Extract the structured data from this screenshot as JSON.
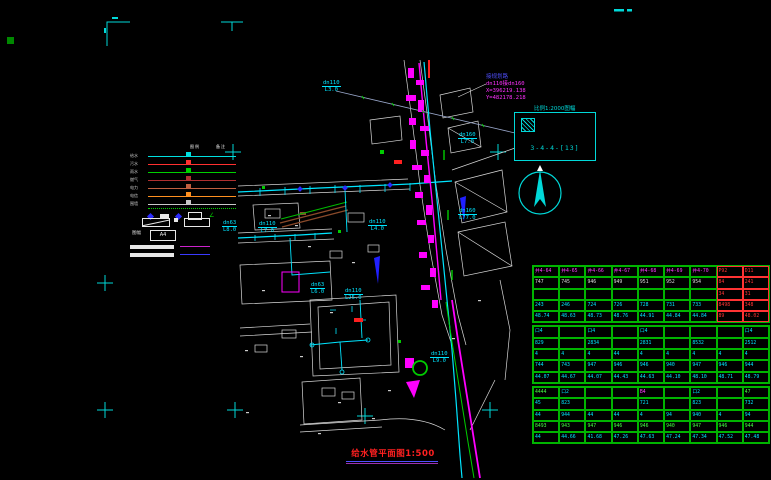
{
  "annotation": {
    "road": "接规划路",
    "pipe": "dn110接dn160",
    "coord_x": "X=396219.138",
    "coord_y": "Y=482178.218"
  },
  "sheet": {
    "scale_note": "比例1:2000图幅",
    "number": "3-4-4-[13]"
  },
  "title": {
    "text": "给水管平面图1:500"
  },
  "legend": {
    "col1": "图例",
    "col2": "备注",
    "paper_label": "图幅",
    "paper_size": "A4",
    "rows": [
      {
        "name": "给水",
        "color": "#00e0e0"
      },
      {
        "name": "污水",
        "color": "#ff3030"
      },
      {
        "name": "雨水",
        "color": "#00d000"
      },
      {
        "name": "燃气",
        "color": "#b03030"
      },
      {
        "name": "电力",
        "color": "#c06040"
      },
      {
        "name": "电信",
        "color": "#ff9020"
      },
      {
        "name": "围墙",
        "color": "#c8c8c8"
      }
    ]
  },
  "drawing": {
    "labels": [
      {
        "x": 322,
        "y": 80,
        "l1": "dn110",
        "l2": "L3.0"
      },
      {
        "x": 222,
        "y": 220,
        "l1": "dn63",
        "l2": "L8.0"
      },
      {
        "x": 258,
        "y": 221,
        "l1": "dn110",
        "l2": "L7.0"
      },
      {
        "x": 368,
        "y": 219,
        "l1": "dn110",
        "l2": "L4.0"
      },
      {
        "x": 310,
        "y": 282,
        "l1": "dn63",
        "l2": "L6.0"
      },
      {
        "x": 344,
        "y": 288,
        "l1": "dn110",
        "l2": "L25.0"
      },
      {
        "x": 458,
        "y": 132,
        "l1": "dn160",
        "l2": "L7.0"
      },
      {
        "x": 458,
        "y": 208,
        "l1": "dn160",
        "l2": "L77.0"
      },
      {
        "x": 430,
        "y": 351,
        "l1": "dn110",
        "l2": "L9.0"
      }
    ]
  },
  "table": {
    "sections": [
      {
        "rows": [
          [
            [
              "井4-64",
              "m"
            ],
            [
              "井4-65",
              "m"
            ],
            [
              "井4-66",
              "m"
            ],
            [
              "井4-67",
              "m"
            ],
            [
              "井4-68",
              "m"
            ],
            [
              "井4-69",
              "m"
            ],
            [
              "井4-70",
              "m"
            ],
            [
              "P92",
              "r"
            ],
            [
              "D11",
              "r"
            ]
          ],
          [
            [
              "747",
              "w"
            ],
            [
              "745",
              "w"
            ],
            [
              "946",
              "w"
            ],
            [
              "949",
              "w"
            ],
            [
              "951",
              "w"
            ],
            [
              "952",
              "w"
            ],
            [
              "954",
              "w"
            ],
            [
              "84",
              "r"
            ],
            [
              "241",
              "r"
            ]
          ],
          [
            [
              "",
              ""
            ],
            [
              "",
              ""
            ],
            [
              "",
              ""
            ],
            [
              "",
              ""
            ],
            [
              "",
              ""
            ],
            [
              "",
              ""
            ],
            [
              "",
              ""
            ],
            [
              "34",
              "r"
            ],
            [
              "31",
              "r"
            ]
          ],
          [
            [
              "243",
              "c"
            ],
            [
              "246",
              "c"
            ],
            [
              "724",
              "c"
            ],
            [
              "726",
              "c"
            ],
            [
              "728",
              "c"
            ],
            [
              "731",
              "c"
            ],
            [
              "733",
              "c"
            ],
            [
              "8498",
              "r"
            ],
            [
              "348",
              "r"
            ]
          ],
          [
            [
              "48.74",
              "c"
            ],
            [
              "48.63",
              "c"
            ],
            [
              "48.73",
              "c"
            ],
            [
              "48.76",
              "c"
            ],
            [
              "44.91",
              "c"
            ],
            [
              "44.84",
              "c"
            ],
            [
              "44.84",
              "c"
            ],
            [
              "89",
              "r"
            ],
            [
              "48.02",
              "r"
            ]
          ]
        ]
      },
      {
        "rows": [
          [
            [
              "口4",
              "c"
            ],
            [
              "",
              ""
            ],
            [
              "口4",
              "c"
            ],
            [
              "",
              ""
            ],
            [
              "口4",
              "c"
            ],
            [
              "",
              ""
            ],
            [
              "",
              ""
            ],
            [
              "",
              ""
            ],
            [
              "口4",
              "c"
            ]
          ],
          [
            [
              "829",
              "c"
            ],
            [
              "",
              ""
            ],
            [
              "2834",
              "c"
            ],
            [
              "",
              ""
            ],
            [
              "2831",
              "c"
            ],
            [
              "",
              ""
            ],
            [
              "8532",
              "c"
            ],
            [
              "",
              ""
            ],
            [
              "2512",
              "c"
            ]
          ],
          [
            [
              "4",
              "c"
            ],
            [
              "4",
              "c"
            ],
            [
              "4",
              "c"
            ],
            [
              "44",
              "c"
            ],
            [
              "4",
              "c"
            ],
            [
              "4",
              "c"
            ],
            [
              "4",
              "c"
            ],
            [
              "4",
              "c"
            ],
            [
              "4",
              "c"
            ]
          ],
          [
            [
              "744",
              "c"
            ],
            [
              "743",
              "c"
            ],
            [
              "947",
              "c"
            ],
            [
              "946",
              "c"
            ],
            [
              "946",
              "c"
            ],
            [
              "940",
              "c"
            ],
            [
              "947",
              "c"
            ],
            [
              "946",
              "c"
            ],
            [
              "944",
              "c"
            ]
          ],
          [
            [
              "44.07",
              "c"
            ],
            [
              "44.67",
              "c"
            ],
            [
              "44.07",
              "c"
            ],
            [
              "44.43",
              "c"
            ],
            [
              "44.63",
              "c"
            ],
            [
              "44.10",
              "c"
            ],
            [
              "48.10",
              "c"
            ],
            [
              "48.71",
              "c"
            ],
            [
              "48.79",
              "c"
            ]
          ]
        ]
      },
      {
        "rows": [
          [
            [
              "4444",
              "g"
            ],
            [
              "口2",
              "c"
            ],
            [
              "",
              ""
            ],
            [
              "",
              ""
            ],
            [
              "B4",
              "m"
            ],
            [
              "",
              ""
            ],
            [
              "口2",
              "c"
            ],
            [
              "",
              ""
            ],
            [
              "47",
              "g"
            ]
          ],
          [
            [
              "45",
              "c"
            ],
            [
              "823",
              "c"
            ],
            [
              "",
              ""
            ],
            [
              "",
              ""
            ],
            [
              "721",
              "c"
            ],
            [
              "",
              ""
            ],
            [
              "823",
              "c"
            ],
            [
              "",
              ""
            ],
            [
              "732",
              "c"
            ]
          ],
          [
            [
              "44",
              "c"
            ],
            [
              "944",
              "c"
            ],
            [
              "44",
              "c"
            ],
            [
              "44",
              "c"
            ],
            [
              "4",
              "c"
            ],
            [
              "94",
              "c"
            ],
            [
              "940",
              "c"
            ],
            [
              "4",
              "c"
            ],
            [
              "94",
              "c"
            ]
          ],
          [
            [
              "8493",
              "g"
            ],
            [
              "943",
              "g"
            ],
            [
              "947",
              "g"
            ],
            [
              "946",
              "g"
            ],
            [
              "946",
              "g"
            ],
            [
              "940",
              "g"
            ],
            [
              "947",
              "g"
            ],
            [
              "946",
              "g"
            ],
            [
              "944",
              "g"
            ]
          ],
          [
            [
              "44",
              "c"
            ],
            [
              "44.66",
              "c"
            ],
            [
              "41.68",
              "c"
            ],
            [
              "47.26",
              "c"
            ],
            [
              "47.63",
              "c"
            ],
            [
              "47.24",
              "c"
            ],
            [
              "47.34",
              "c"
            ],
            [
              "47.52",
              "c"
            ],
            [
              "47.48",
              "c"
            ]
          ]
        ]
      }
    ]
  }
}
